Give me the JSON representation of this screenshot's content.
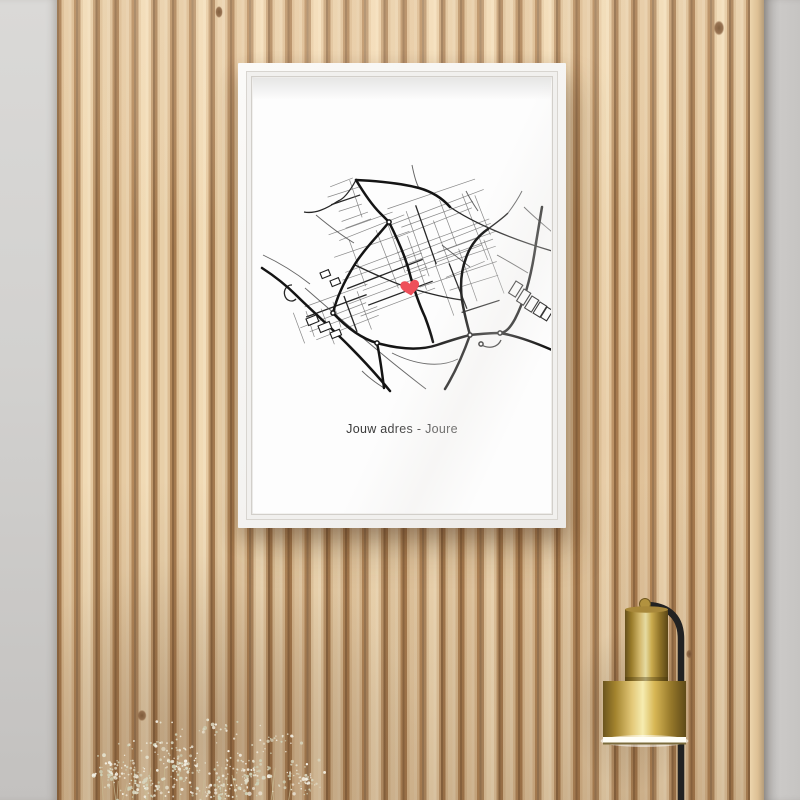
{
  "palette": {
    "wall_gray": "#cfcdcb",
    "wood_slat_light": "#efd7b0",
    "wood_slat_dark": "#8d6944",
    "frame_white": "#f6f5f3",
    "poster_white": "#fdfdfd",
    "road_black": "#141414",
    "road_gray": "#6a6a6a",
    "heart_red": "#ee4f5a",
    "brass_gold": "#d8b755",
    "lamp_arm_black": "#222222",
    "flower_white": "#f3efe2"
  },
  "poster": {
    "title": "Jouw adres - Joure"
  },
  "map": {
    "heart": {
      "x": 154,
      "y": 192,
      "color": "#ee4f5a"
    },
    "clusters": [
      {
        "x": 136,
        "y": 96,
        "w": 112,
        "h": 86,
        "angle": -20,
        "step": 7,
        "seed": 11
      },
      {
        "x": 78,
        "y": 124,
        "w": 92,
        "h": 94,
        "angle": -20,
        "step": 8,
        "seed": 23
      },
      {
        "x": 42,
        "y": 202,
        "w": 84,
        "h": 46,
        "angle": -20,
        "step": 8,
        "seed": 37
      },
      {
        "x": 72,
        "y": 86,
        "w": 44,
        "h": 50,
        "angle": -20,
        "step": 9,
        "seed": 51
      },
      {
        "x": 186,
        "y": 148,
        "w": 60,
        "h": 64,
        "angle": -20,
        "step": 8,
        "seed": 67
      }
    ],
    "major_roads": [
      "M100,85 C106,95 116,110 124,118 C127,121 130,124 133,127",
      "M100,85 C122,86 144,88 163,93 C177,97 187,104 194,112",
      "M133,127 C122,141 109,153 99,169 C89,185 81,201 77,218",
      "M77,218 C92,234 107,244 121,248 C146,255 166,255 181,250 C196,245 206,242 214,240",
      "M206,205 C208,218 211,229 214,240",
      "M206,205 C204,190 205,176 210,163 C214,151 222,141 232,134",
      "M133,127 C141,143 149,161 153,176 C157,191 163,209 169,222 C172,230 175,239 177,247",
      "M6,173 C20,182 31,191 41,201 C60,220 98,252 134,296",
      "M121,248 C124,262 126,277 128,293",
      "M214,240 C208,257 200,276 189,294",
      "M244,238 C262,241 280,248 296,255",
      "M280,148 C277,170 271,201 259,224 C254,233 250,237 245,238",
      "M280,148 C282,136 284,124 286,112",
      "M214,240 C224,239 234,238 244,238"
    ],
    "medium_roads": [
      "M99,170 C122,181 140,189 154,193 C174,199 191,203 206,205",
      "M194,112 C216,127 252,143 296,156",
      "M100,85 C94,96 88,104 82,106",
      "M82,106 C70,114 59,119 48,117",
      "M224,249 C233,255 242,252 245,245",
      "M36,190 a7,8 0 1 0 4,14",
      "M232,134 C240,128 247,123 252,118"
    ],
    "minor_roads": [
      "M49,193 C80,220 112,248 142,272 C152,280 162,288 170,294",
      "M136,258 C160,270 184,273 202,264",
      "M7,160 C24,168 40,178 54,189",
      "M60,120 C72,130 85,140 98,148",
      "M186,150 C196,158 206,166 214,172",
      "M252,118 C258,110 263,102 266,96",
      "M268,112 C278,122 288,130 296,137",
      "M156,70 C158,80 160,88 163,93",
      "M210,96 C214,104 218,110 222,116",
      "M241,160 C252,166 262,172 272,178",
      "M128,293 C120,288 112,282 106,276"
    ],
    "buildings": [
      {
        "x": 260,
        "y": 186,
        "w": 8,
        "h": 14,
        "a": 32
      },
      {
        "x": 268,
        "y": 194,
        "w": 8,
        "h": 14,
        "a": 32
      },
      {
        "x": 276,
        "y": 201,
        "w": 8,
        "h": 14,
        "a": 32
      },
      {
        "x": 284,
        "y": 207,
        "w": 8,
        "h": 13,
        "a": 32
      },
      {
        "x": 291,
        "y": 212,
        "w": 7,
        "h": 12,
        "a": 32
      },
      {
        "x": 50,
        "y": 224,
        "w": 11,
        "h": 7,
        "a": -22
      },
      {
        "x": 62,
        "y": 231,
        "w": 12,
        "h": 7,
        "a": -22
      },
      {
        "x": 74,
        "y": 238,
        "w": 10,
        "h": 6,
        "a": -22
      },
      {
        "x": 64,
        "y": 178,
        "w": 9,
        "h": 6,
        "a": -22
      },
      {
        "x": 74,
        "y": 186,
        "w": 9,
        "h": 6,
        "a": -22
      }
    ],
    "nodes": [
      {
        "x": 77,
        "y": 218
      },
      {
        "x": 121,
        "y": 248
      },
      {
        "x": 214,
        "y": 240
      },
      {
        "x": 244,
        "y": 238
      },
      {
        "x": 225,
        "y": 249
      },
      {
        "x": 133,
        "y": 127
      }
    ]
  },
  "decor": {
    "lamp": {
      "gradient": [
        "#6b541d",
        "#a3842e",
        "#e3c878",
        "#f6ecb0",
        "#d8b755",
        "#96782a",
        "#5f4a18"
      ],
      "arm": "#222222",
      "rim": "#fffef6"
    },
    "flowers": {
      "seed": 9,
      "colors": [
        "#f7f4ea",
        "#efe9da",
        "#e4e0cc",
        "#d9d8c2",
        "#cfd2b8"
      ],
      "clusters": [
        {
          "x": 60,
          "y": 85,
          "rx": 40,
          "ry": 26,
          "n": 70
        },
        {
          "x": 120,
          "y": 75,
          "rx": 45,
          "ry": 30,
          "n": 85
        },
        {
          "x": 185,
          "y": 82,
          "rx": 45,
          "ry": 28,
          "n": 80
        },
        {
          "x": 245,
          "y": 92,
          "rx": 32,
          "ry": 22,
          "n": 55
        },
        {
          "x": 95,
          "y": 100,
          "rx": 50,
          "ry": 18,
          "n": 60
        },
        {
          "x": 170,
          "y": 104,
          "rx": 60,
          "ry": 14,
          "n": 60
        },
        {
          "x": 150,
          "y": 40,
          "rx": 70,
          "ry": 18,
          "n": 26
        },
        {
          "x": 100,
          "y": 58,
          "rx": 50,
          "ry": 16,
          "n": 22
        },
        {
          "x": 215,
          "y": 55,
          "rx": 45,
          "ry": 16,
          "n": 22
        }
      ],
      "stems": 18
    }
  }
}
